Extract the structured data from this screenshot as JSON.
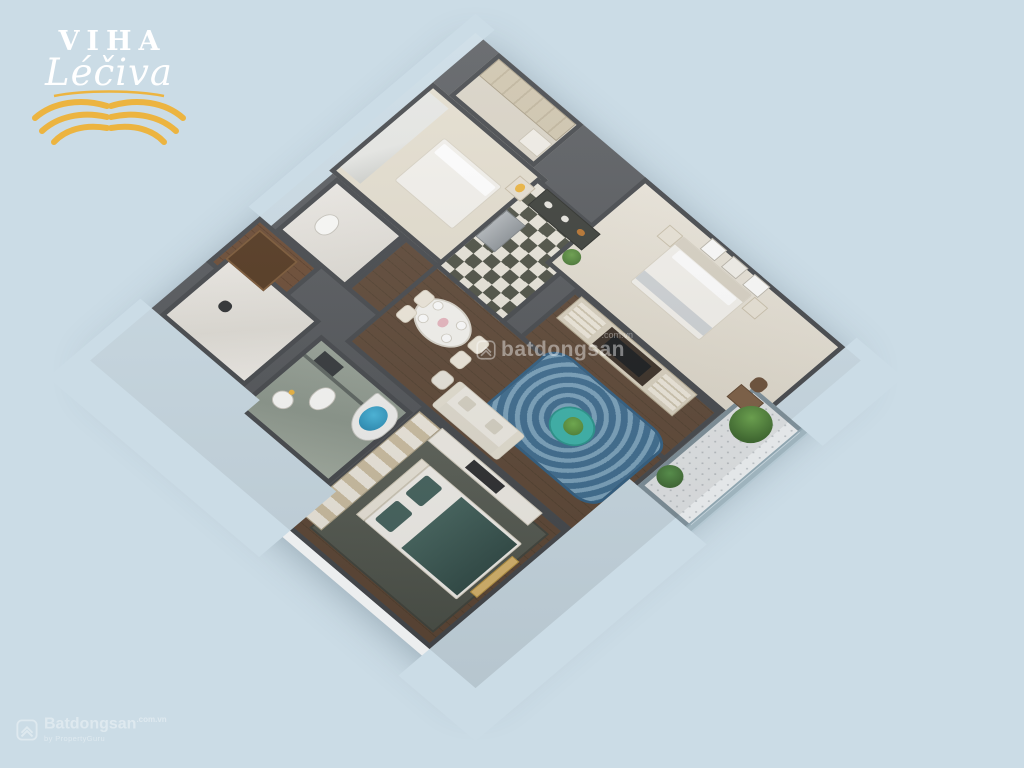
{
  "page": {
    "width": 1024,
    "height": 768,
    "colors": {
      "background": "#cbdce6",
      "wall": "#53565a",
      "exterior": "#eceeef",
      "wood_floor": "#5d4736",
      "gold": "#ecb440",
      "rug_blue": "#3f6d90",
      "coffee_table_teal": "#3cb4ab",
      "checker_dark": "#4d5044",
      "checker_light": "#e9e5da",
      "bath_marble_green": "#97a195",
      "bed2_blanket_teal": "#3e5d59",
      "watermark": "#ffffff"
    }
  },
  "logo": {
    "line1": "VIHA",
    "line2": "Léčiva",
    "text_color": "#ffffff",
    "wing_color": "#ecb440"
  },
  "watermarks": {
    "center": {
      "brand": "batdongsan",
      "domain": ".com.vn"
    },
    "corner": {
      "brand": "Batdongsan",
      "domain": ".com.vn",
      "tagline": "by PropertyGuru"
    }
  },
  "scene": {
    "type": "3d-isometric-apartment-floorplan",
    "view": "cutaway top-down 3D render, diamond orientation on plain background",
    "rooms": [
      {
        "id": "closet",
        "label": "wardrobe nook with vanity"
      },
      {
        "id": "bedroom-3",
        "label": "small bedroom with white bed, marble accent wall, nightstand lamp"
      },
      {
        "id": "bathroom-1",
        "label": "white marble bathroom"
      },
      {
        "id": "entry-hall",
        "label": "entry hall with dark wood door"
      },
      {
        "id": "kitchen",
        "label": "kitchen with black-white checkered tile, steel fridge, dark counter"
      },
      {
        "id": "master-bedroom",
        "label": "master bedroom: white bed, two nightstands, three art frames, desk and chair"
      },
      {
        "id": "living-room",
        "label": "living room: blue swirl rug, teal round coffee table with plant, cream sofa, walnut TV wall"
      },
      {
        "id": "dining-area",
        "label": "dining: white oval table, four chairs, place settings"
      },
      {
        "id": "balcony",
        "label": "patterned-tile balcony with two green shrubs and glass railing"
      },
      {
        "id": "bathroom-2",
        "label": "green marble bathroom with corner jacuzzi (blue water), toilet, sink"
      },
      {
        "id": "utility-room",
        "label": "white marble utility room"
      },
      {
        "id": "bedroom-2",
        "label": "bedroom with teal blanket bed, gold bench, beige paneled wardrobe, dark rug"
      }
    ]
  }
}
